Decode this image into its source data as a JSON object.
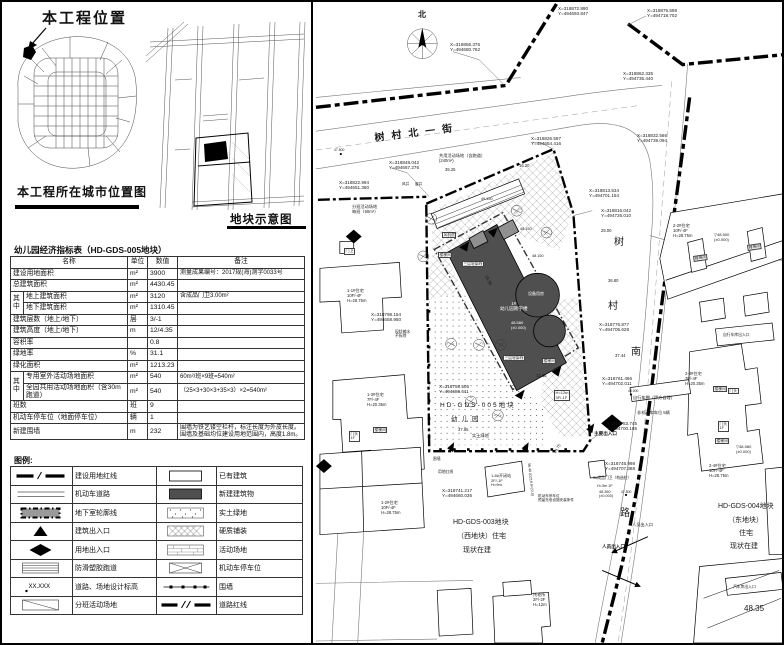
{
  "location_map": {
    "title": "本工程位置",
    "caption": "本工程所在城市位置图"
  },
  "plot_map": {
    "caption": "地块示意图"
  },
  "table": {
    "title": "幼儿园经济指标表（HD-GDS-005地块）",
    "headers": [
      "名称",
      "单位",
      "数值",
      "备注"
    ],
    "rows": [
      {
        "name": "建设用地面积",
        "unit": "m²",
        "value": "3900",
        "remark": "测量成果编号：2017规(海)测字0033号"
      },
      {
        "name": "总建筑面积",
        "unit": "m²",
        "value": "4430.45",
        "remark": ""
      },
      {
        "group": "其中",
        "first": true,
        "name": "地上建筑面积",
        "unit": "m²",
        "value": "3120",
        "remark": "含成品门卫3.00m²"
      },
      {
        "group": "其中",
        "name": "地下建筑面积",
        "unit": "m²",
        "value": "1310.45",
        "remark": ""
      },
      {
        "name": "建筑层数（地上/地下）",
        "unit": "层",
        "value": "3/-1",
        "remark": ""
      },
      {
        "name": "建筑高度（地上/地下）",
        "unit": "m",
        "value": "12/4.35",
        "remark": ""
      },
      {
        "name": "容积率",
        "unit": "",
        "value": "0.8",
        "remark": ""
      },
      {
        "name": "绿地率",
        "unit": "%",
        "value": "31.1",
        "remark": ""
      },
      {
        "name": "绿化面积",
        "unit": "m²",
        "value": "1213.23",
        "remark": ""
      },
      {
        "group": "其中",
        "first": true,
        "name": "专用室外活动场地面积",
        "unit": "m²",
        "value": "540",
        "remark": "60m²/班×9班=540m²"
      },
      {
        "group": "其中",
        "name": "全园共用活动场地面积（含30m跑道）",
        "unit": "m²",
        "value": "540",
        "remark": "（25×3+30×3+35×3）×2=540m²"
      },
      {
        "name": "班数",
        "unit": "班",
        "value": "9",
        "remark": ""
      },
      {
        "name": "机动车停车位（地面停车位）",
        "unit": "辆",
        "value": "1",
        "remark": ""
      },
      {
        "name": "新建围墙",
        "unit": "m",
        "value": "232",
        "remark": "围墙为铁艺镂空栏杆，标注长度为外皮长度。围墙及基础均位建设用地范围内，高度1.8m。"
      }
    ]
  },
  "legend": {
    "title": "图例:",
    "left": [
      {
        "sym": "red-boundary",
        "label": "建设用地红线"
      },
      {
        "sym": "road",
        "label": "机动车道路"
      },
      {
        "sym": "basement",
        "label": "地下室轮廓线"
      },
      {
        "sym": "bldg-entry",
        "label": "建筑出入口"
      },
      {
        "sym": "site-entry",
        "label": "用地出入口"
      },
      {
        "sym": "track",
        "label": "防滑塑胶跑道"
      },
      {
        "sym": "spot-elev",
        "label": "道路、场地设计标高",
        "symtext": "XX.XXX"
      },
      {
        "sym": "class-area",
        "label": "分班活动场地"
      }
    ],
    "right": [
      {
        "sym": "existing",
        "label": "已有建筑"
      },
      {
        "sym": "new-bldg",
        "label": "新建建筑物"
      },
      {
        "sym": "green",
        "label": "实土绿地"
      },
      {
        "sym": "paving",
        "label": "硬质铺装"
      },
      {
        "sym": "activity",
        "label": "活动场地"
      },
      {
        "sym": "parking",
        "label": "机动车停车位"
      },
      {
        "sym": "fence",
        "label": "围墙"
      },
      {
        "sym": "road-redline",
        "label": "道路红线"
      }
    ]
  },
  "site_plan": {
    "colors": {
      "new_building": "#4f4f4f",
      "redline": "#000000"
    },
    "texts": [
      {
        "t": "北",
        "x": 416,
        "y": 8,
        "s": 8,
        "w": 700,
        "n": "north-label"
      },
      {
        "t": "树村北一街",
        "x": 372,
        "y": 131,
        "s": 10,
        "r": -7,
        "ls": 7,
        "w": 700,
        "n": "street-name"
      },
      {
        "t": "树",
        "x": 612,
        "y": 235,
        "s": 10,
        "n": "street-name"
      },
      {
        "t": "村",
        "x": 606,
        "y": 299,
        "s": 10,
        "n": "street-name"
      },
      {
        "t": "南",
        "x": 629,
        "y": 345,
        "s": 10,
        "n": "street-name"
      },
      {
        "t": "路",
        "x": 618,
        "y": 506,
        "s": 10,
        "n": "street-name"
      },
      {
        "t": "X=318856.376\nY=494680.762",
        "x": 448,
        "y": 40,
        "s": 4.6,
        "n": "coordinate-label"
      },
      {
        "t": "X=318872.890\nY=494693.847",
        "x": 556,
        "y": 4,
        "s": 4.6,
        "n": "coordinate-label"
      },
      {
        "t": "X=318875.598\nY=494718.702",
        "x": 645,
        "y": 6,
        "s": 4.6,
        "n": "coordinate-label"
      },
      {
        "t": "X=318862.335\nY=494735.440",
        "x": 621,
        "y": 69,
        "s": 4.6,
        "n": "coordinate-label"
      },
      {
        "t": "X=318832.566\nY=494739.094",
        "x": 635,
        "y": 131,
        "s": 4.6,
        "n": "coordinate-label"
      },
      {
        "t": "X=318848.042\nY=494667.276",
        "x": 387,
        "y": 158,
        "s": 4.6,
        "n": "coordinate-label"
      },
      {
        "t": "X=318822.994\nY=494651.360",
        "x": 337,
        "y": 178,
        "s": 4.6,
        "n": "coordinate-label"
      },
      {
        "t": "X=318826.597\nY=494654.416",
        "x": 529,
        "y": 134,
        "s": 4.6,
        "n": "coordinate-label"
      },
      {
        "t": "X=318813.534\nY=494701.154",
        "x": 587,
        "y": 186,
        "s": 4.6,
        "n": "coordinate-label"
      },
      {
        "t": "X=318816.042\nY=494726.010",
        "x": 599,
        "y": 206,
        "s": 4.6,
        "n": "coordinate-label"
      },
      {
        "t": "X=318776.877\nY=494705.628",
        "x": 597,
        "y": 320,
        "s": 4.6,
        "n": "coordinate-label"
      },
      {
        "t": "X=318761.466\nY=494702.011",
        "x": 600,
        "y": 374,
        "s": 4.6,
        "n": "coordinate-label"
      },
      {
        "t": "X=318753.745\nY=494700.185",
        "x": 605,
        "y": 419,
        "s": 4.6,
        "n": "coordinate-label"
      },
      {
        "t": "X=318745.998\nY=494707.388",
        "x": 603,
        "y": 459,
        "s": 4.6,
        "n": "coordinate-label"
      },
      {
        "t": "X=318758.505\nY=494686.611",
        "x": 437,
        "y": 382,
        "s": 4.6,
        "n": "coordinate-label"
      },
      {
        "t": "X=318741.217\nY=494660.036",
        "x": 440,
        "y": 486,
        "s": 4.6,
        "n": "coordinate-label"
      },
      {
        "t": "X=318798.154\nY=494658.950",
        "x": 369,
        "y": 310,
        "s": 4.6,
        "n": "coordinate-label"
      },
      {
        "t": "HD-GDS-005地块",
        "x": 438,
        "y": 400,
        "s": 6.5,
        "ls": 2,
        "n": "plot-id"
      },
      {
        "t": "幼儿园",
        "x": 449,
        "y": 414,
        "s": 6.5,
        "ls": 4,
        "n": "plot-id"
      },
      {
        "t": "HD-GDS-003地块",
        "x": 451,
        "y": 517,
        "s": 7,
        "n": "plot-id"
      },
      {
        "t": "（西地块）住宅",
        "x": 455,
        "y": 531,
        "s": 7,
        "n": "plot-label"
      },
      {
        "t": "现状在建",
        "x": 461,
        "y": 545,
        "s": 7,
        "n": "plot-label"
      },
      {
        "t": "HD-GDS-004地块",
        "x": 716,
        "y": 501,
        "s": 7,
        "n": "plot-id"
      },
      {
        "t": "（东地块）",
        "x": 726,
        "y": 515,
        "s": 7,
        "n": "plot-label"
      },
      {
        "t": "住宅",
        "x": 737,
        "y": 528,
        "s": 7,
        "n": "plot-label"
      },
      {
        "t": "现状在建",
        "x": 728,
        "y": 541,
        "s": 7,
        "n": "plot-label"
      },
      {
        "t": "1#\n幼儿园教学楼",
        "x": 498,
        "y": 299,
        "s": 4.6,
        "c": "#ffffff",
        "ta": "center",
        "n": "kindergarten-label"
      },
      {
        "t": "48.580\n(±0.000)",
        "x": 509,
        "y": 319,
        "s": 4,
        "c": "#ffffff",
        "n": "elevation-label"
      },
      {
        "t": "设备用房",
        "x": 526,
        "y": 290,
        "s": 4,
        "c": "#ffffff",
        "n": "room-label"
      },
      {
        "t": "1-1#住宅\n10F/-4F\nH=28.75m",
        "x": 345,
        "y": 287,
        "s": 4.2,
        "n": "building-label"
      },
      {
        "t": "1-3#住宅\n7F/-4F\nH=20.35m",
        "x": 365,
        "y": 391,
        "s": 4.2,
        "n": "building-label"
      },
      {
        "t": "1-2#住宅\n10F/-4F\nH=28.75m",
        "x": 379,
        "y": 499,
        "s": 4.2,
        "n": "building-label"
      },
      {
        "t": "2-2#住宅\n10F/-4F\nH=28.75m",
        "x": 671,
        "y": 222,
        "s": 4.2,
        "n": "building-label"
      },
      {
        "t": "2-3#住宅\n7F/-4F\nH=20.35m",
        "x": 683,
        "y": 370,
        "s": 4.2,
        "n": "building-label"
      },
      {
        "t": "2-4#住宅\n10F/-4F\nH=28.75m",
        "x": 707,
        "y": 462,
        "s": 4.2,
        "n": "building-label"
      },
      {
        "t": "托老所\n2F/-2F\nH=12m",
        "x": 531,
        "y": 591,
        "s": 4.2,
        "n": "building-label"
      },
      {
        "t": "1-8#开闭站\n2F/-1F\nH=9m",
        "x": 489,
        "y": 472,
        "s": 4,
        "n": "building-label"
      },
      {
        "t": "H=12m\n3F/-1F",
        "x": 552,
        "y": 388,
        "s": 4,
        "bg": 1,
        "n": "building-label"
      },
      {
        "t": "风机房",
        "x": 440,
        "y": 230,
        "s": 3.8,
        "bg": 1,
        "n": "room-label"
      },
      {
        "t": "楼梯间",
        "x": 436,
        "y": 250,
        "s": 3.8,
        "bg": 1,
        "n": "room-label"
      },
      {
        "t": "三层轮廓线",
        "x": 460,
        "y": 259,
        "s": 3.8,
        "bg": 1,
        "n": "outline-label"
      },
      {
        "t": "三层轮廓线",
        "x": 501,
        "y": 353,
        "s": 3.8,
        "bg": 1,
        "n": "outline-label"
      },
      {
        "t": "楼梯间",
        "x": 540,
        "y": 356,
        "s": 3.8,
        "bg": 1,
        "n": "room-label"
      },
      {
        "t": "楼梯间",
        "x": 691,
        "y": 254,
        "s": 3.8,
        "bg": 1,
        "r": -8,
        "n": "room-label"
      },
      {
        "t": "楼梯间",
        "x": 745,
        "y": 243,
        "s": 3.8,
        "bg": 1,
        "r": -8,
        "n": "room-label"
      },
      {
        "t": "楼梯间",
        "x": 711,
        "y": 384,
        "s": 3.8,
        "bg": 1,
        "n": "room-label"
      },
      {
        "t": "门头",
        "x": 726,
        "y": 386,
        "s": 3.8,
        "bg": 1,
        "n": "room-label"
      },
      {
        "t": "门头\n1F",
        "x": 716,
        "y": 419,
        "s": 3.8,
        "bg": 1,
        "n": "room-label"
      },
      {
        "t": "楼梯间",
        "x": 713,
        "y": 436,
        "s": 3.8,
        "bg": 1,
        "n": "room-label"
      },
      {
        "t": "楼梯间",
        "x": 371,
        "y": 425,
        "s": 3.8,
        "bg": 1,
        "n": "room-label"
      },
      {
        "t": "门头\n1F",
        "x": 347,
        "y": 429,
        "s": 3.8,
        "bg": 1,
        "n": "room-label"
      },
      {
        "t": "门卫",
        "x": 342,
        "y": 246,
        "s": 4,
        "bg": 1,
        "n": "guard-house-label"
      },
      {
        "t": "▽48.500\n(±0.000)",
        "x": 712,
        "y": 231,
        "s": 4,
        "n": "elevation-label"
      },
      {
        "t": "▽48.580\n(±0.000)",
        "x": 734,
        "y": 443,
        "s": 4,
        "n": "elevation-label"
      },
      {
        "t": "48.360\n(±0.000)",
        "x": 597,
        "y": 488,
        "s": 3.8,
        "n": "elevation-label"
      },
      {
        "t": "49.150",
        "x": 479,
        "y": 195,
        "s": 3.8,
        "n": "elevation-label"
      },
      {
        "t": "48.150",
        "x": 518,
        "y": 225,
        "s": 3.8,
        "n": "elevation-label"
      },
      {
        "t": "48.150",
        "x": 530,
        "y": 252,
        "s": 3.8,
        "n": "elevation-label"
      },
      {
        "t": "47.800",
        "x": 332,
        "y": 146,
        "s": 3.4,
        "n": "elevation-label"
      },
      {
        "t": "47.800",
        "x": 619,
        "y": 488,
        "s": 3.4,
        "n": "elevation-label"
      },
      {
        "t": "48.000",
        "x": 626,
        "y": 387,
        "s": 3.4,
        "n": "elevation-label"
      },
      {
        "t": "48.35",
        "x": 742,
        "y": 602,
        "s": 8,
        "n": "elevation-label"
      },
      {
        "t": "3#成品门卫（构造柱）",
        "x": 591,
        "y": 474,
        "s": 3.8,
        "n": "guard-house-label"
      },
      {
        "t": "H=3m 1F",
        "x": 595,
        "y": 482,
        "s": 3.8,
        "n": "building-label"
      },
      {
        "t": "自行车棚（甲方自理）",
        "x": 631,
        "y": 394,
        "s": 4.2,
        "n": "facility-label"
      },
      {
        "t": "非机动车车位 5辆",
        "x": 635,
        "y": 409,
        "s": 4.2,
        "n": "facility-label"
      },
      {
        "t": "自行车库出入口",
        "x": 721,
        "y": 331,
        "s": 3.8,
        "n": "entrance-label"
      },
      {
        "t": "汽车库出入口",
        "x": 731,
        "y": 583,
        "s": 3.8,
        "n": "entrance-label"
      },
      {
        "t": "主要出入口",
        "x": 592,
        "y": 429,
        "s": 4.6,
        "w": 700,
        "n": "entrance-label"
      },
      {
        "t": "人员出入口",
        "x": 630,
        "y": 521,
        "s": 4.2,
        "n": "entrance-label"
      },
      {
        "t": "人员出入口",
        "x": 600,
        "y": 542,
        "s": 4.6,
        "w": 700,
        "n": "entrance-label"
      },
      {
        "t": "用地红线",
        "x": 436,
        "y": 468,
        "s": 3.8,
        "n": "redline-label"
      },
      {
        "t": "围墙",
        "x": 431,
        "y": 455,
        "s": 3.8,
        "n": "fence-label"
      },
      {
        "t": "实土绿地",
        "x": 470,
        "y": 432,
        "s": 4.2,
        "n": "area-label"
      },
      {
        "t": "分班活动场地\n每班（60m²）",
        "x": 350,
        "y": 203,
        "s": 4.2,
        "n": "area-label"
      },
      {
        "t": "共用活动场地（含跑道）\n(240m²)",
        "x": 437,
        "y": 152,
        "s": 4.2,
        "n": "area-label"
      },
      {
        "t": "现状输水\n不拆除",
        "x": 393,
        "y": 328,
        "s": 3.8,
        "n": "note-label"
      },
      {
        "t": "机动车停车位\n预留充电设施安装条件",
        "x": 536,
        "y": 492,
        "s": 3.6,
        "n": "note-label"
      },
      {
        "t": "风井",
        "x": 400,
        "y": 180,
        "s": 3.6,
        "n": "shaft-label"
      },
      {
        "t": "窗井",
        "x": 413,
        "y": 180,
        "s": 3.6,
        "n": "shaft-label"
      },
      {
        "t": "35.25",
        "x": 443,
        "y": 166,
        "s": 4.2,
        "n": "dimension-label"
      },
      {
        "t": "16.20",
        "x": 517,
        "y": 162,
        "s": 4.2,
        "n": "dimension-label"
      },
      {
        "t": "19.35",
        "x": 486,
        "y": 272,
        "s": 4.4,
        "r": 62,
        "n": "dimension-label"
      },
      {
        "t": "13.65",
        "x": 534,
        "y": 372,
        "s": 4.2,
        "n": "dimension-label"
      },
      {
        "t": "37.85",
        "x": 456,
        "y": 426,
        "s": 4.2,
        "n": "dimension-label"
      },
      {
        "t": "37.44",
        "x": 613,
        "y": 352,
        "s": 4.2,
        "n": "dimension-label"
      },
      {
        "t": "36.80",
        "x": 606,
        "y": 277,
        "s": 4.2,
        "n": "dimension-label"
      },
      {
        "t": "25.00",
        "x": 599,
        "y": 227,
        "s": 4.2,
        "n": "dimension-label"
      },
      {
        "t": "10.75",
        "x": 551,
        "y": 450,
        "s": 4,
        "r": -58,
        "n": "dimension-label"
      },
      {
        "t": "56.40 (D219.9=22.0)",
        "x": 529,
        "y": 461,
        "s": 3.6,
        "r": 84,
        "n": "dimension-label"
      }
    ]
  }
}
